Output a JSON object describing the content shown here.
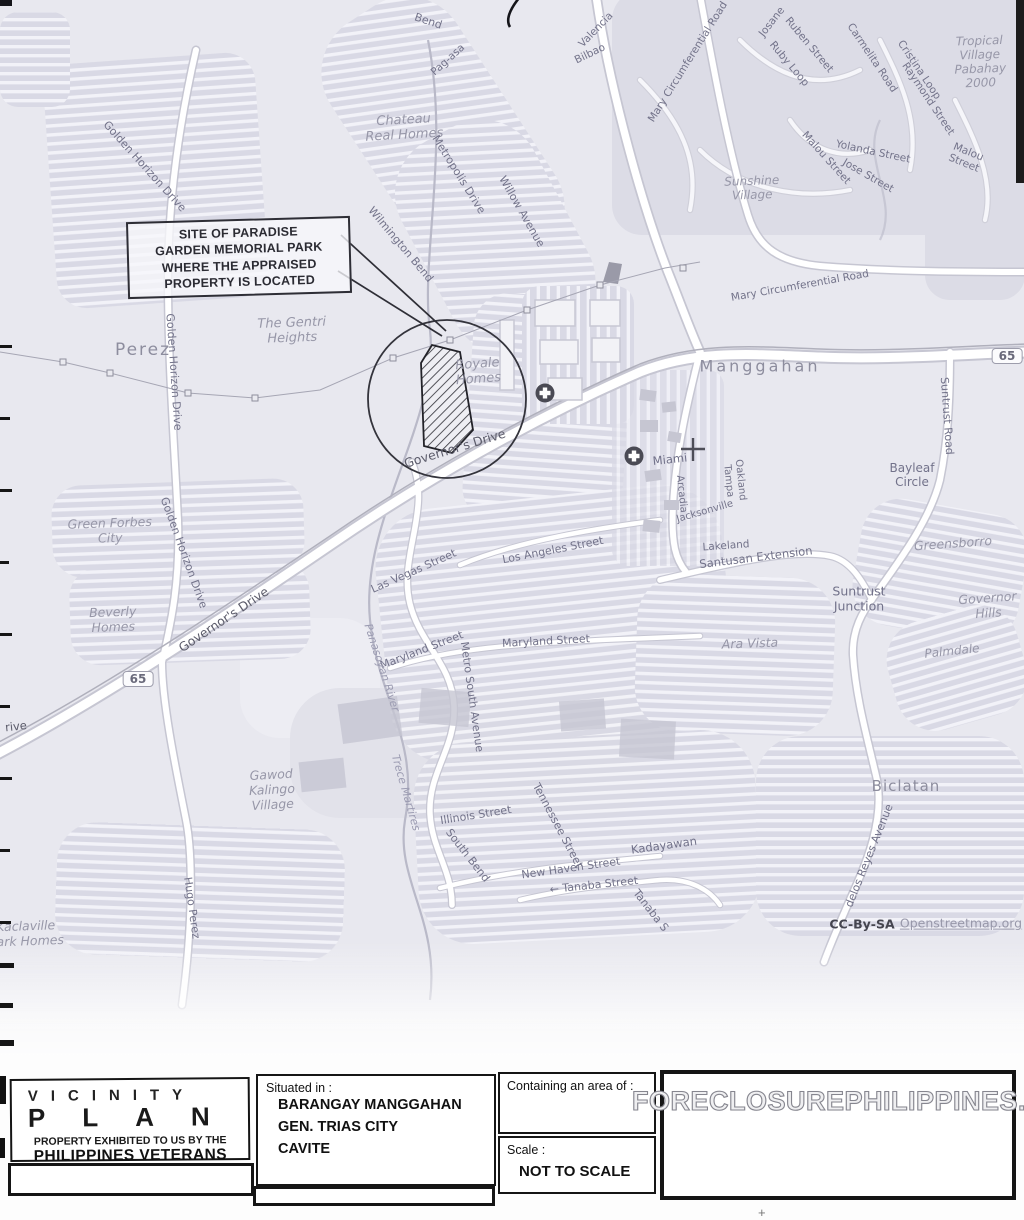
{
  "colors": {
    "map_bg": "#e8e8ef",
    "road_fill": "#ffffff",
    "road_casing": "#c6c6d2",
    "label_gray": "#78788c",
    "ink": "#151515"
  },
  "callout": {
    "text": "SITE OF PARADISE\nGARDEN MEMORIAL PARK\nWHERE THE APPRAISED\nPROPERTY IS LOCATED"
  },
  "map": {
    "shields": [
      {
        "t": "65",
        "x": 138,
        "y": 679
      },
      {
        "t": "65",
        "x": 1007,
        "y": 356
      }
    ],
    "labels": [
      {
        "t": "Bend",
        "x": 428,
        "y": 22,
        "r": 18,
        "s": 11,
        "k": "street"
      },
      {
        "t": "Pag-asa",
        "x": 448,
        "y": 60,
        "r": -42,
        "s": 10.5,
        "k": "street"
      },
      {
        "t": "Chateau\nReal Homes",
        "x": 404,
        "y": 128,
        "r": -3,
        "s": 13,
        "k": "place"
      },
      {
        "t": "Wilmington Bend",
        "x": 400,
        "y": 245,
        "r": 50,
        "s": 11,
        "k": "street"
      },
      {
        "t": "Royale\nHomes",
        "x": 478,
        "y": 372,
        "r": -4,
        "s": 13,
        "k": "place"
      },
      {
        "t": "Metropolis Drive",
        "x": 458,
        "y": 175,
        "r": 58,
        "s": 11,
        "k": "street"
      },
      {
        "t": "Willow Avenue",
        "x": 521,
        "y": 212,
        "r": 60,
        "s": 11,
        "k": "street"
      },
      {
        "t": "Valencia",
        "x": 596,
        "y": 30,
        "r": -46,
        "s": 10.5,
        "k": "street"
      },
      {
        "t": "Bilbao",
        "x": 590,
        "y": 54,
        "r": -26,
        "s": 10.5,
        "k": "street"
      },
      {
        "t": "Mary Circumferential Road",
        "x": 688,
        "y": 62,
        "r": -58,
        "s": 10.5,
        "k": "street"
      },
      {
        "t": "Josane",
        "x": 772,
        "y": 22,
        "r": -52,
        "s": 10.5,
        "k": "street"
      },
      {
        "t": "Ruben Street",
        "x": 809,
        "y": 45,
        "r": 50,
        "s": 10.5,
        "k": "street"
      },
      {
        "t": "Ruby Loop",
        "x": 789,
        "y": 64,
        "r": 50,
        "s": 10.5,
        "k": "street"
      },
      {
        "t": "Carmelita Road",
        "x": 872,
        "y": 58,
        "r": 56,
        "s": 10.5,
        "k": "street"
      },
      {
        "t": "Cristina Loop",
        "x": 919,
        "y": 70,
        "r": 56,
        "s": 10.5,
        "k": "street"
      },
      {
        "t": "Raymond Street",
        "x": 928,
        "y": 99,
        "r": 56,
        "s": 10.5,
        "k": "street"
      },
      {
        "t": "Malou Street",
        "x": 826,
        "y": 158,
        "r": 48,
        "s": 10.5,
        "k": "street"
      },
      {
        "t": "Yolanda Street",
        "x": 873,
        "y": 152,
        "r": 12,
        "s": 10.5,
        "k": "street"
      },
      {
        "t": "Jose Street",
        "x": 868,
        "y": 176,
        "r": 30,
        "s": 10.5,
        "k": "street"
      },
      {
        "t": "Malou Street",
        "x": 966,
        "y": 158,
        "r": 22,
        "s": 10.5,
        "k": "street"
      },
      {
        "t": "Sunshine\nVillage",
        "x": 752,
        "y": 188,
        "r": -2,
        "s": 12,
        "k": "place"
      },
      {
        "t": "Tropical\nVillage\nPabahay\n2000",
        "x": 980,
        "y": 62,
        "r": -2,
        "s": 12,
        "k": "place"
      },
      {
        "t": "Mary Circumferential Road",
        "x": 800,
        "y": 286,
        "r": -10,
        "s": 10.5,
        "k": "street"
      },
      {
        "t": "Manggahan",
        "x": 760,
        "y": 367,
        "r": 0,
        "s": 16,
        "k": "town",
        "sp": 3
      },
      {
        "t": "Suntrust Road",
        "x": 946,
        "y": 416,
        "r": 86,
        "s": 11,
        "k": "street"
      },
      {
        "t": "Bayleaf\nCircle",
        "x": 912,
        "y": 475,
        "r": 0,
        "s": 12,
        "k": "locality"
      },
      {
        "t": "Golden Horizon Drive",
        "x": 144,
        "y": 167,
        "r": 48,
        "s": 11,
        "k": "street"
      },
      {
        "t": "Perez",
        "x": 143,
        "y": 350,
        "r": 0,
        "s": 17,
        "k": "town",
        "sp": 2
      },
      {
        "t": "The Gentri\nHeights",
        "x": 292,
        "y": 331,
        "r": -2,
        "s": 13,
        "k": "place"
      },
      {
        "t": "Golden Horizon Drive",
        "x": 173,
        "y": 372,
        "r": 86,
        "s": 11,
        "k": "street"
      },
      {
        "t": "Golden Horizon Drive",
        "x": 183,
        "y": 553,
        "r": 70,
        "s": 11,
        "k": "street"
      },
      {
        "t": "Governor's Drive",
        "x": 455,
        "y": 449,
        "r": -17,
        "s": 12.5,
        "k": "street-dark"
      },
      {
        "t": "Governor's Drive",
        "x": 224,
        "y": 620,
        "r": -34,
        "s": 12.5,
        "k": "street-dark"
      },
      {
        "t": "Green Forbes\nCity",
        "x": 110,
        "y": 531,
        "r": -2,
        "s": 12.5,
        "k": "place"
      },
      {
        "t": "Beverly\nHomes",
        "x": 113,
        "y": 620,
        "r": -2,
        "s": 12.5,
        "k": "place"
      },
      {
        "t": "rive",
        "x": 16,
        "y": 727,
        "r": -6,
        "s": 11.5,
        "k": "street-dark"
      },
      {
        "t": "Miami",
        "x": 670,
        "y": 460,
        "r": -6,
        "s": 11.5,
        "k": "locality"
      },
      {
        "t": "Arcadia",
        "x": 681,
        "y": 494,
        "r": 84,
        "s": 10,
        "k": "street"
      },
      {
        "t": "Jacksonville",
        "x": 705,
        "y": 512,
        "r": -16,
        "s": 10,
        "k": "street"
      },
      {
        "t": "Tampa",
        "x": 728,
        "y": 481,
        "r": 84,
        "s": 10,
        "k": "street"
      },
      {
        "t": "Oakland",
        "x": 740,
        "y": 480,
        "r": 84,
        "s": 10,
        "k": "street"
      },
      {
        "t": "Lakeland",
        "x": 726,
        "y": 546,
        "r": -4,
        "s": 10.5,
        "k": "street"
      },
      {
        "t": "Santusan Extension",
        "x": 756,
        "y": 558,
        "r": -7,
        "s": 11.5,
        "k": "street"
      },
      {
        "t": "Las Vegas Street",
        "x": 414,
        "y": 572,
        "r": -24,
        "s": 11,
        "k": "street"
      },
      {
        "t": "Los Angeles Street",
        "x": 553,
        "y": 551,
        "r": -11,
        "s": 11,
        "k": "street"
      },
      {
        "t": "Maryland Street",
        "x": 422,
        "y": 651,
        "r": -21,
        "s": 11,
        "k": "street"
      },
      {
        "t": "Maryland Street",
        "x": 546,
        "y": 642,
        "r": -3,
        "s": 11,
        "k": "street"
      },
      {
        "t": "Metro South Avenue",
        "x": 471,
        "y": 697,
        "r": 82,
        "s": 11,
        "k": "street"
      },
      {
        "t": "Panasoyan River",
        "x": 381,
        "y": 668,
        "r": 72,
        "s": 11,
        "k": "river"
      },
      {
        "t": "Ara Vista",
        "x": 750,
        "y": 644,
        "r": -2,
        "s": 12.5,
        "k": "place"
      },
      {
        "t": "Suntrust\nJunction",
        "x": 859,
        "y": 599,
        "r": 0,
        "s": 12.5,
        "k": "locality"
      },
      {
        "t": "Greensborro",
        "x": 953,
        "y": 544,
        "r": -4,
        "s": 12.5,
        "k": "place"
      },
      {
        "t": "Governor\nHills",
        "x": 988,
        "y": 606,
        "r": -4,
        "s": 12.5,
        "k": "place"
      },
      {
        "t": "Palmdale",
        "x": 952,
        "y": 651,
        "r": -6,
        "s": 12,
        "k": "place"
      },
      {
        "t": "Gawod\nKalingo\nVillage",
        "x": 272,
        "y": 790,
        "r": -3,
        "s": 12.5,
        "k": "place"
      },
      {
        "t": "Trece Martires",
        "x": 405,
        "y": 793,
        "r": 74,
        "s": 11,
        "k": "river"
      },
      {
        "t": "Illinois Street",
        "x": 476,
        "y": 816,
        "r": -9,
        "s": 11,
        "k": "street"
      },
      {
        "t": "South Bend",
        "x": 467,
        "y": 856,
        "r": 52,
        "s": 11,
        "k": "street"
      },
      {
        "t": "Tennessee Street",
        "x": 557,
        "y": 826,
        "r": 62,
        "s": 11,
        "k": "street"
      },
      {
        "t": "New Haven Street",
        "x": 571,
        "y": 869,
        "r": -8,
        "s": 11,
        "k": "street"
      },
      {
        "t": "← Tanaba Street",
        "x": 594,
        "y": 886,
        "r": -6,
        "s": 11,
        "k": "street"
      },
      {
        "t": "Tanaba S",
        "x": 650,
        "y": 911,
        "r": 52,
        "s": 11,
        "k": "street"
      },
      {
        "t": "Kadayawan",
        "x": 664,
        "y": 846,
        "r": -8,
        "s": 11.5,
        "k": "locality"
      },
      {
        "t": "Hugo Perez",
        "x": 191,
        "y": 908,
        "r": 82,
        "s": 11,
        "k": "street"
      },
      {
        "t": "Biclatan",
        "x": 906,
        "y": 787,
        "r": 0,
        "s": 15,
        "k": "town",
        "sp": 1
      },
      {
        "t": "delos Reyes Avenue",
        "x": 870,
        "y": 856,
        "r": -68,
        "s": 11,
        "k": "street"
      },
      {
        "t": "Kaclaville\npark Homes",
        "x": 26,
        "y": 934,
        "r": -2,
        "s": 12.5,
        "k": "place"
      },
      {
        "t": "CC-By-SA",
        "x": 862,
        "y": 925,
        "r": 0,
        "s": 12.5,
        "k": "attr"
      },
      {
        "t": "Openstreetmap.org",
        "x": 961,
        "y": 924,
        "r": 0,
        "s": 12.5,
        "k": "link"
      }
    ]
  },
  "title_block": {
    "plan_word1": "VICINITY",
    "plan_word2": "PLAN",
    "property_line1": "PROPERTY EXHIBITED TO US BY THE",
    "property_line2": "PHILIPPINES VETERANS BANK",
    "situated_label": "Situated in :",
    "situated_lines": [
      "BARANGAY MANGGAHAN",
      "GEN. TRIAS CITY",
      "CAVITE"
    ],
    "area_label": "Containing an area of :",
    "scale_label": "Scale :",
    "scale_value": "NOT TO SCALE",
    "watermark": "FORECLOSUREPHILIPPINES.COM"
  }
}
